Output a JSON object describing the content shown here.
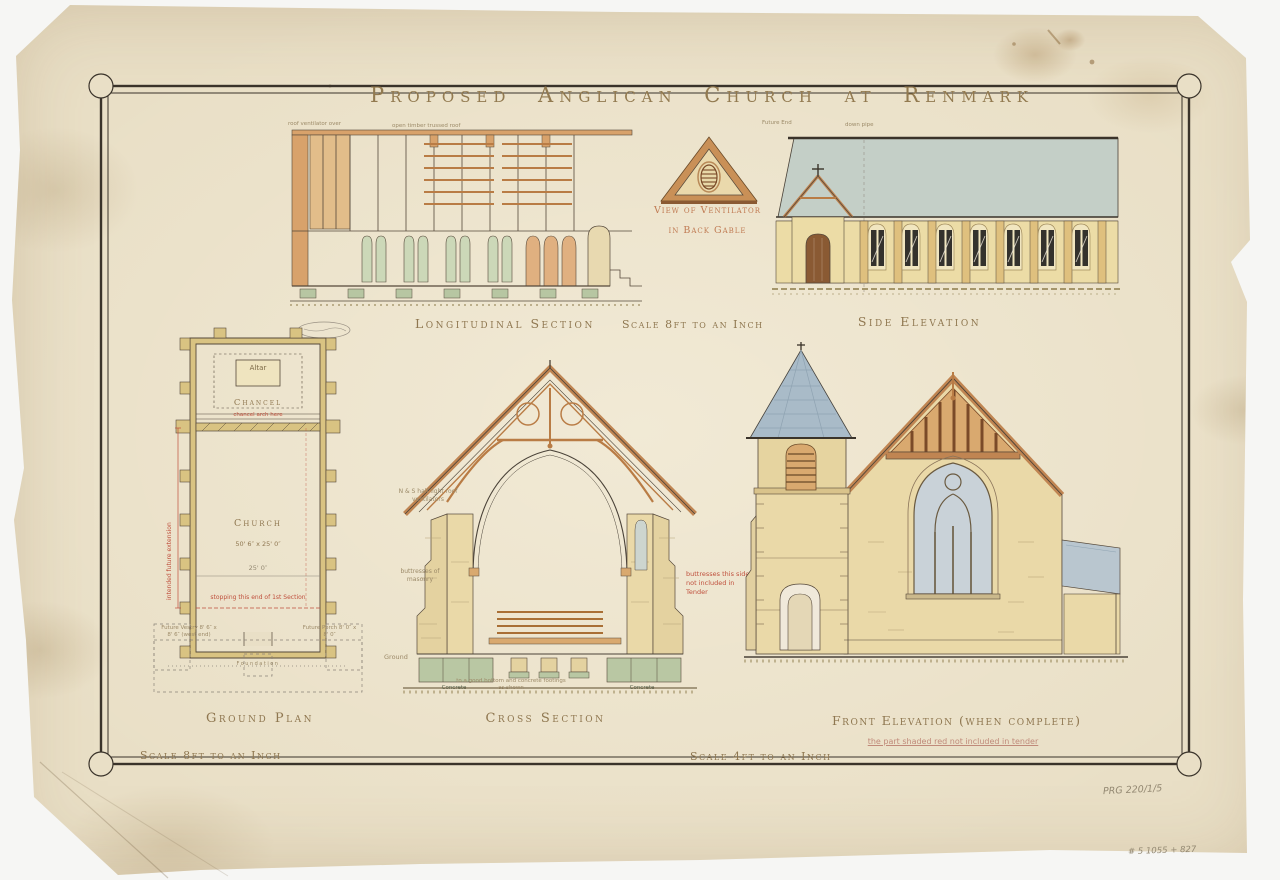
{
  "title": "Proposed Anglican Church at Renmark",
  "drawings": {
    "longitudinal_section": {
      "caption": "Longitudinal Section",
      "scale": "Scale 8ft to an Inch",
      "pencil_note_left": "roof ventilator over",
      "pencil_note_right": "open timber trussed roof"
    },
    "ventilator_detail": {
      "caption_line1": "View of Ventilator",
      "caption_line2": "in Back Gable"
    },
    "side_elevation": {
      "caption": "Side Elevation",
      "pencil_note_left": "Future End",
      "pencil_note_right": "down pipe"
    },
    "ground_plan": {
      "caption": "Ground Plan",
      "scale": "Scale 8ft to an Inch",
      "labels": {
        "altar": "Altar",
        "chancel": "Chancel",
        "chancel_red_note": "chancel arch here",
        "church": "Church",
        "church_dims": "50' 6″ x 25' 0″",
        "width_dim": "25' 0″",
        "stopping_red_note": "stopping this end of 1st Section",
        "future_vestry": "Future Vestry 8' 6″ x 8' 6″ (west end)",
        "future_porch": "Future Porch 8' 0″ x 8' 0″",
        "foundation": "Foundation",
        "extension_red_note": "intended future extension"
      }
    },
    "cross_section": {
      "caption": "Cross Section",
      "scale": "Scale 4ft to an Inch",
      "labels": {
        "roof_note": "N & S half light roof ventilators",
        "buttress_note": "buttresses of masonry",
        "red_note": "buttresses this side not included in Tender",
        "ground": "Ground",
        "concrete_left": "Concrete",
        "concrete_right": "Concrete",
        "footing_note": "to a good bottom and concrete footings as shown"
      }
    },
    "front_elevation": {
      "caption": "Front Elevation (when complete)",
      "red_note": "the part shaded red not included in tender"
    }
  },
  "annotations": {
    "archive_ref": "PRG 220/1/5",
    "pencil_ref": "# 5 1055 + 827"
  }
}
